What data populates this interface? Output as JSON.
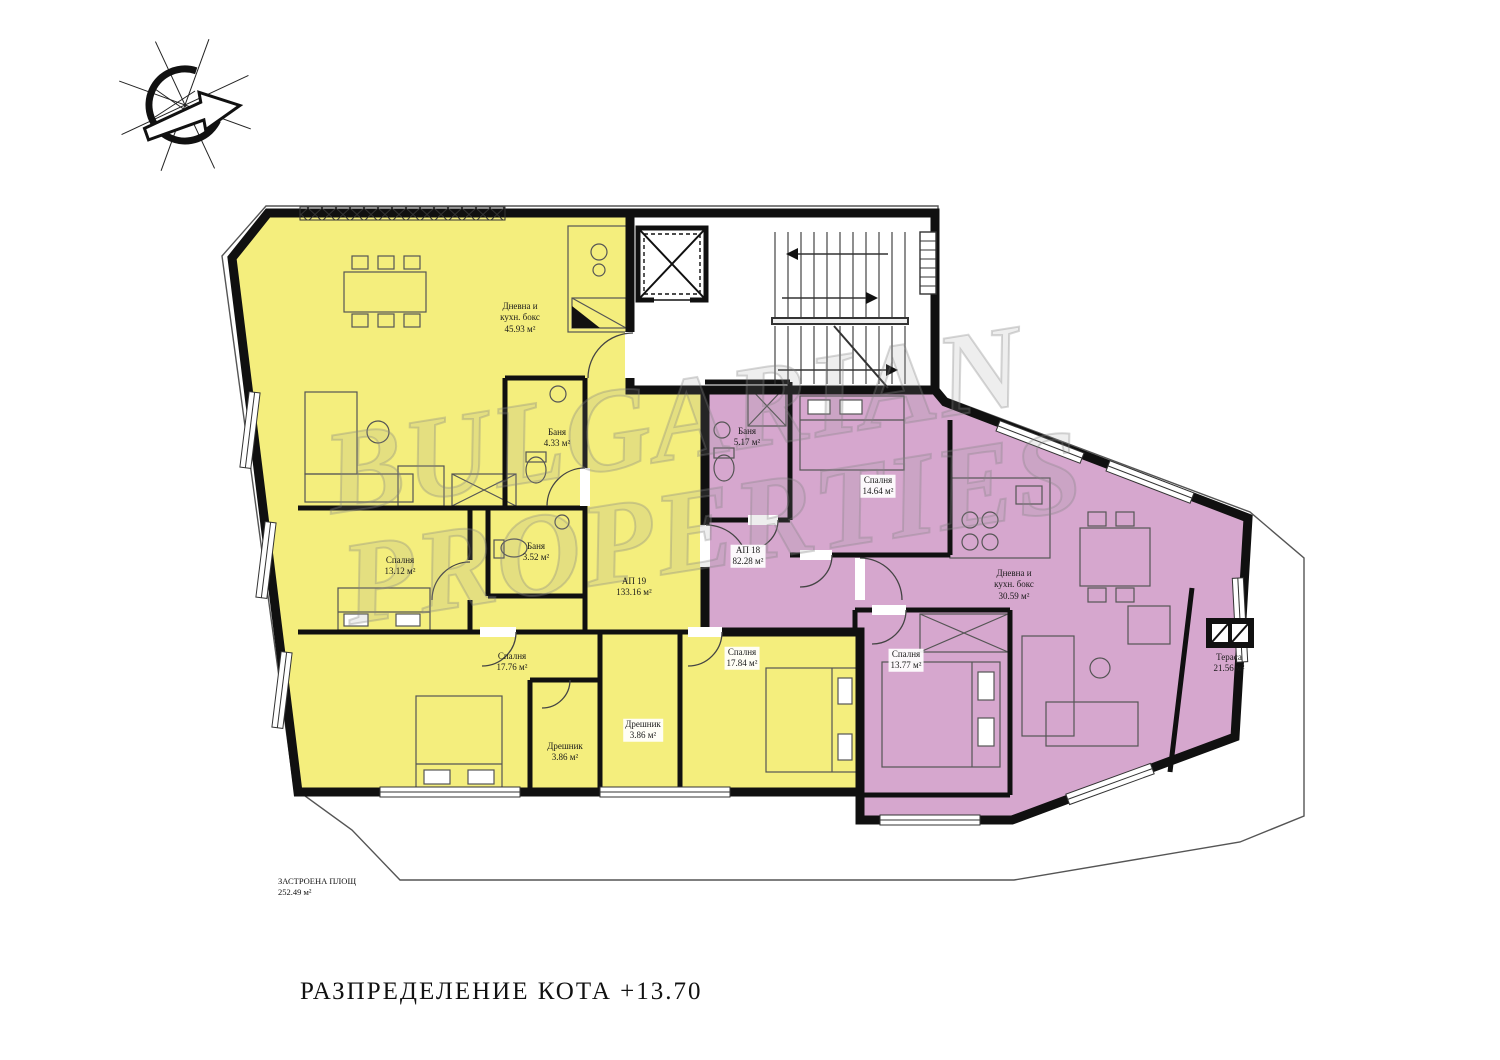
{
  "title": "РАЗПРЕДЕЛЕНИЕ КОТА +13.70",
  "watermark": {
    "line1": "BULGARIAN",
    "line2": "PROPERTIES"
  },
  "footprint": {
    "label": "ЗАСТРОЕНА ПЛОЩ",
    "area": "252.49 м²"
  },
  "colors": {
    "ap19": "#F4EE7D",
    "ap18": "#D6A7CE",
    "wall": "#101010",
    "thin": "#555555"
  },
  "apartments": [
    {
      "id": "АП 19",
      "area": "133.16 м²",
      "color": "#F4EE7D"
    },
    {
      "id": "АП 18",
      "area": "82.28 м²",
      "color": "#D6A7CE"
    }
  ],
  "rooms": [
    {
      "lines": [
        "Дневна и",
        "кухн. бокс",
        "45.93 м²"
      ],
      "x": 520,
      "y": 318,
      "boxed": false
    },
    {
      "lines": [
        "Баня",
        "4.33 м²"
      ],
      "x": 557,
      "y": 438,
      "boxed": false
    },
    {
      "lines": [
        "Баня",
        "3.52 м²"
      ],
      "x": 536,
      "y": 552,
      "boxed": false
    },
    {
      "lines": [
        "АП 19",
        "133.16 м²"
      ],
      "x": 634,
      "y": 587,
      "boxed": false
    },
    {
      "lines": [
        "Спалня",
        "13.12 м²"
      ],
      "x": 400,
      "y": 566,
      "boxed": false
    },
    {
      "lines": [
        "Спалня",
        "17.76 м²"
      ],
      "x": 512,
      "y": 662,
      "boxed": false
    },
    {
      "lines": [
        "Дрешник",
        "3.86 м²"
      ],
      "x": 565,
      "y": 752,
      "boxed": false
    },
    {
      "lines": [
        "Дрешник",
        "3.86 м²"
      ],
      "x": 643,
      "y": 730,
      "boxed": true
    },
    {
      "lines": [
        "Спалня",
        "17.84 м²"
      ],
      "x": 742,
      "y": 658,
      "boxed": true
    },
    {
      "lines": [
        "Баня",
        "5.17 м²"
      ],
      "x": 747,
      "y": 437,
      "boxed": false
    },
    {
      "lines": [
        "Спалня",
        "14.64 м²"
      ],
      "x": 878,
      "y": 486,
      "boxed": true
    },
    {
      "lines": [
        "АП 18",
        "82.28 м²"
      ],
      "x": 748,
      "y": 556,
      "boxed": true
    },
    {
      "lines": [
        "Дневна и",
        "кухн. бокс",
        "30.59 м²"
      ],
      "x": 1014,
      "y": 585,
      "boxed": false
    },
    {
      "lines": [
        "Спалня",
        "13.77 м²"
      ],
      "x": 906,
      "y": 660,
      "boxed": true
    },
    {
      "lines": [
        "Тераса",
        "21.56 м²"
      ],
      "x": 1229,
      "y": 663,
      "boxed": false
    }
  ]
}
